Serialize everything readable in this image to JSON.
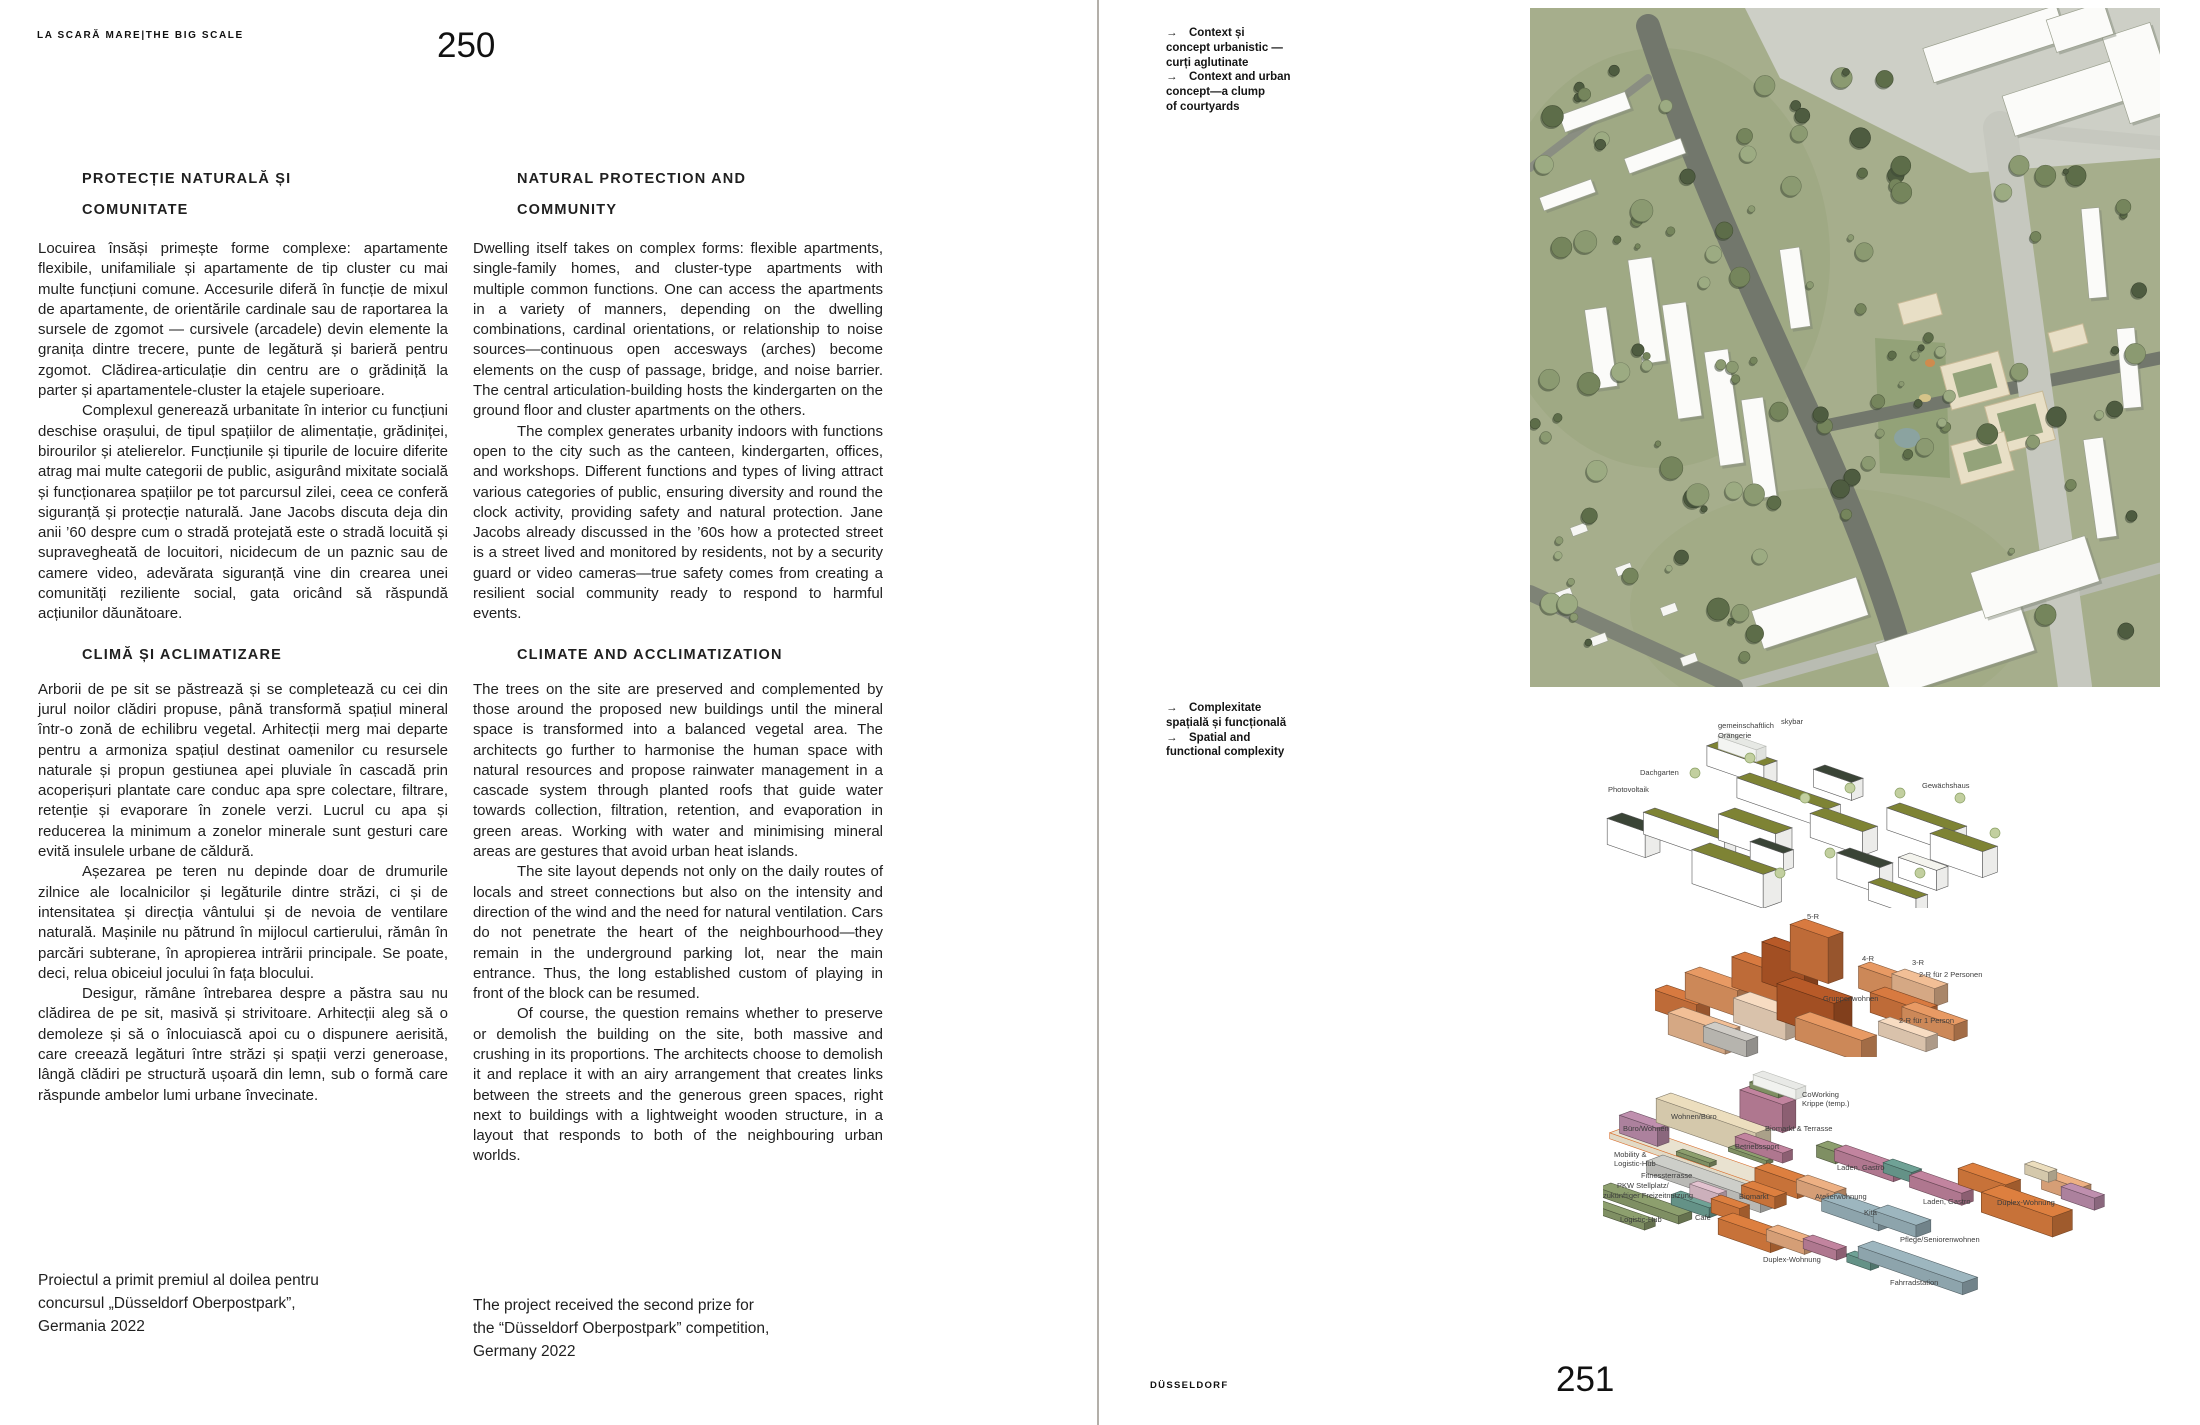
{
  "book": {
    "left_page": {
      "running_head": "LA SCARĂ MARE|THE BIG SCALE",
      "page_number": "250",
      "ro": {
        "heading1": "PROTECȚIE NATURALĂ ȘI\nCOMUNITATE",
        "para1": "Locuirea însăși primește forme complexe: apartamente flexibile, unifamiliale și apartamente de tip cluster cu mai multe funcțiuni comune. Accesurile diferă în funcție de mixul de apartamente, de orientările cardinale sau de raportarea la sursele de zgomot — cursivele (arcadele) devin elemente la granița dintre trecere, punte de legătură și barieră pentru zgomot. Clădirea-articulație din centru are o grădiniță la parter și apartamentele-cluster la etajele superioare.",
        "para2": "Complexul generează urbanitate în interior cu funcțiuni deschise orașului, de tipul spațiilor de alimentație, grădiniței, birourilor și atelierelor. Funcțiunile și tipurile de locuire diferite atrag mai multe categorii de public, asigurând mixitate socială și funcționarea spațiilor pe tot parcursul zilei, ceea ce conferă siguranță și protecție naturală. Jane Jacobs discuta deja din anii ’60 despre cum o stradă protejată este o stradă locuită și supravegheată de locuitori, nicidecum de un paznic sau de camere video, adevărata siguranță vine din crearea unei comunități reziliente social, gata oricând să răspundă acțiunilor dăunătoare.",
        "heading2": "CLIMĂ ȘI ACLIMATIZARE",
        "para3": "Arborii de pe sit se păstrează și se completează cu cei din jurul noilor clădiri propuse, până transformă spațiul mineral într-o zonă de echilibru vegetal. Arhitecții merg mai departe pentru a armoniza spațiul destinat oamenilor cu resursele naturale și propun gestiunea apei pluviale în cascadă prin acoperișuri plantate care conduc apa spre colectare, filtrare, retenție și evaporare în zonele verzi. Lucrul cu apa și reducerea la minimum a zonelor minerale sunt gesturi care evită insulele urbane de căldură.",
        "para4": "Așezarea pe teren nu depinde doar de drumurile zilnice ale localnicilor și legăturile dintre străzi, ci și de intensitatea și direcția vântului și de nevoia de ventilare naturală. Mașinile nu pătrund în mijlocul cartierului, rămân în parcări subterane, în apropierea intrării principale. Se poate, deci, relua obiceiul jocului în fața blocului.",
        "para5": "Desigur, rămâne întrebarea despre a păstra sau nu clădirea de pe sit, masivă și strivitoare. Arhitecții aleg să o demoleze și să o înlocuiască apoi cu o dispunere aerisită, care creează legături între străzi și spații verzi generoase, lângă clădiri pe structură ușoară din lemn, sub o formă care răspunde ambelor lumi urbane învecinate.",
        "credit": "Proiectul a primit premiul al doilea pentru\nconcursul „Düsseldorf Oberpostpark”,\nGermania 2022"
      },
      "en": {
        "heading1": "NATURAL PROTECTION AND\nCOMMUNITY",
        "para1": "Dwelling itself takes on complex forms: flexible apartments, single-family homes, and cluster-type apartments with multiple common functions. One can access the apartments in a variety of manners, depending on the dwelling combinations, cardinal orientations, or relationship to noise sources—continuous open accesways (arches) become elements on the cusp of passage, bridge, and noise barrier. The central articulation-building hosts the kindergarten on the ground floor and cluster apartments on the others.",
        "para2": "The complex generates urbanity indoors with functions open to the city such as the canteen, kindergarten, offices, and workshops. Different functions and types of living attract various categories of public, ensuring diversity and round the clock activity, providing safety and natural protection. Jane Jacobs already discussed in the ’60s how a protected street is a street lived and monitored by residents, not by a security guard or video cameras—true safety comes from creating a resilient social community ready to respond to harmful events.",
        "heading2": "CLIMATE AND ACCLIMATIZATION",
        "para3": "The trees on the site are preserved and complemented by those around the proposed new buildings until the mineral space is transformed into a balanced vegetal area. The architects go further to harmonise the human space with natural resources and propose rainwater management in a cascade system through planted roofs that guide water towards collection, filtration, retention, and evaporation in green areas. Working with water and minimising mineral areas are gestures that avoid urban heat islands.",
        "para4": "The site layout depends not only on the daily routes of locals and street connections but also on the intensity and direction of the wind and the need for natural ventilation. Cars do not penetrate the heart of the neighbourhood—they remain in the underground parking lot, near the main entrance. Thus, the long established custom of playing in front of the block can be resumed.",
        "para5": "Of course, the question remains whether to preserve or demolish the building on the site, both massive and crushing in its proportions. The architects choose to demolish it and replace it with an airy arrangement that creates links between the streets and the generous green spaces, right next to buildings with a lightweight wooden structure, in a layout that responds to both of the neighbouring urban worlds.",
        "credit": "The project received the second prize for\nthe “Düsseldorf Oberpostpark” competition,\nGermany 2022"
      }
    },
    "right_page": {
      "caption_top": "→ Context și\nconcept urbanistic —\ncurți aglutinate\n→ Context and urban\nconcept—a clump\nof courtyards",
      "caption_bottom": "→ Complexitate\nspațială și funcțională\n→ Spatial and\nfunctional complexity",
      "footer_label": "DÜSSELDORF",
      "page_number": "251",
      "diagram1_labels": [
        "gemeinschaftlich",
        "Orangerie",
        "skybar",
        "Dachgarten",
        "Photovoltaik",
        "Gewächshaus"
      ],
      "diagram2_labels": [
        "5-R",
        "4-R",
        "3-R",
        "2-R für 2 Personen",
        "Gruppenwohnen",
        "2-R für 1 Person"
      ],
      "diagram3_labels": [
        "CoWorking",
        "Krippe (temp.)",
        "Wohnen/Büro",
        "Büro/Wohnen",
        "Biomarkt & Terrasse",
        "Betriebssport",
        "Mobility &",
        "Logistic-Hub",
        "Fitnessterrasse",
        "PKW Stellplatz/",
        "zukünftiger Freizeitnutzung",
        "Laden, Gastro",
        "Biomarkt",
        "Atelierwohnung",
        "Logistic-Hub",
        "Café",
        "Kita",
        "Laden, Gastro",
        "Duplex-Wohnung",
        "Pflege/Seniorenwohnen",
        "Duplex-Wohnung",
        "Fahrradstation"
      ]
    }
  }
}
